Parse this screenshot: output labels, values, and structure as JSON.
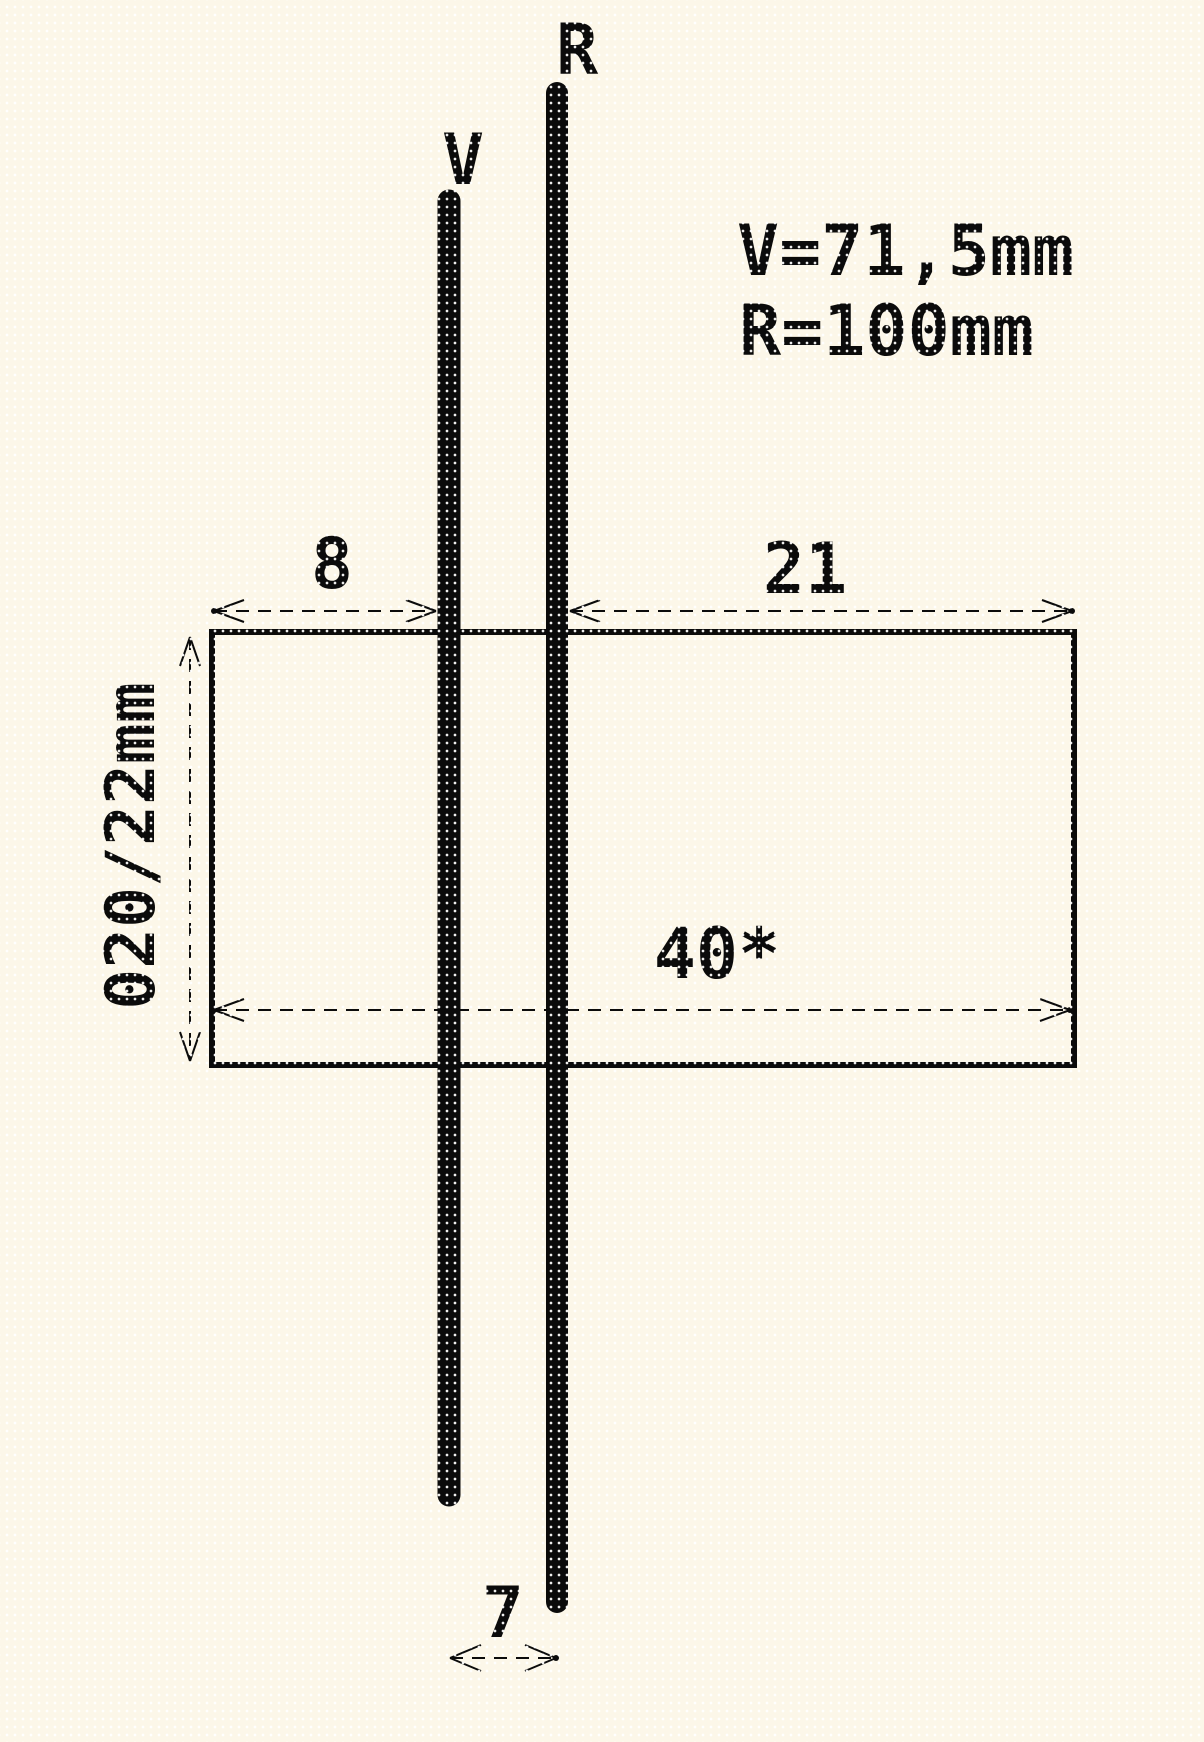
{
  "colors": {
    "background": "#FCF7E9",
    "ink": "#0B0B0B"
  },
  "wires": {
    "v_label": "V",
    "r_label": "R"
  },
  "legend": {
    "v_equation": "V=71,5mm",
    "r_equation": "R=100mm"
  },
  "dimensions": {
    "left_offset": "8",
    "right_offset": "21",
    "overall_width": "40*",
    "wire_spacing": "7",
    "tube_diameter": "020/22mm"
  }
}
